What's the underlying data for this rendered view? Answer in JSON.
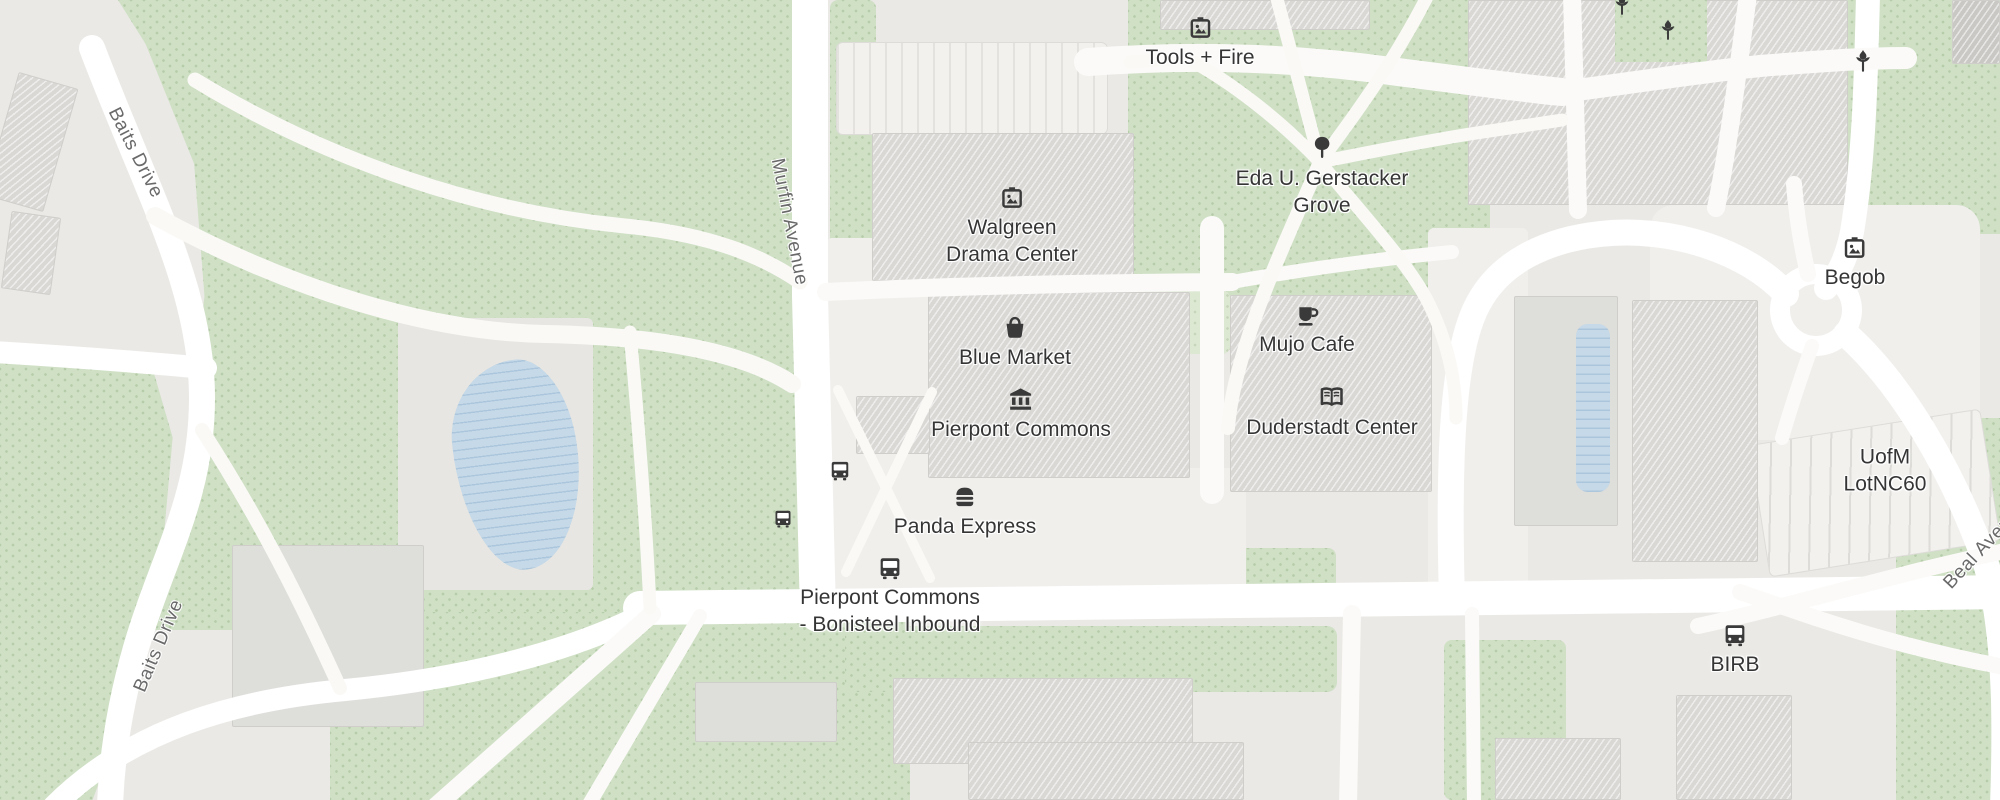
{
  "map": {
    "colors": {
      "land": "#eae9e5",
      "park": "#cfe0c5",
      "water": "#c5d9e8",
      "building": "#d9d8d5",
      "road": "#ffffff",
      "poi_label": "#353535",
      "street_label": "#6a6a6a",
      "icon": "#3a3a3a"
    },
    "pois": {
      "tools_fire": {
        "label": "Tools + Fire",
        "icon": "art-icon"
      },
      "gerstacker_grove": {
        "label": "Eda U. Gerstacker\nGrove",
        "icon": "tree-icon"
      },
      "walgreen_drama": {
        "label": "Walgreen\nDrama Center",
        "icon": "art-icon"
      },
      "blue_market": {
        "label": "Blue Market",
        "icon": "shopping-basket-icon"
      },
      "pierpont_commons": {
        "label": "Pierpont Commons",
        "icon": "bank-icon"
      },
      "mujo_cafe": {
        "label": "Mujo Cafe",
        "icon": "cafe-icon"
      },
      "duderstadt_center": {
        "label": "Duderstadt Center",
        "icon": "book-icon"
      },
      "panda_express": {
        "label": "Panda Express",
        "icon": "restaurant-icon"
      },
      "bonisteel_inbound": {
        "label": "Pierpont Commons\n- Bonisteel Inbound",
        "icon": "bus-icon"
      },
      "birb": {
        "label": "BIRB",
        "icon": "bus-icon"
      },
      "begob": {
        "label": "Begob",
        "icon": "art-icon"
      },
      "lot_nc60": {
        "label": "UofM LotNC60",
        "icon": "none"
      }
    },
    "streets": {
      "baits_drive_north": "Baits Drive",
      "baits_drive_south": "Baits Drive",
      "murfin_avenue": "Murfin Avenue",
      "beal_avenue": "Beal Avenue"
    }
  }
}
